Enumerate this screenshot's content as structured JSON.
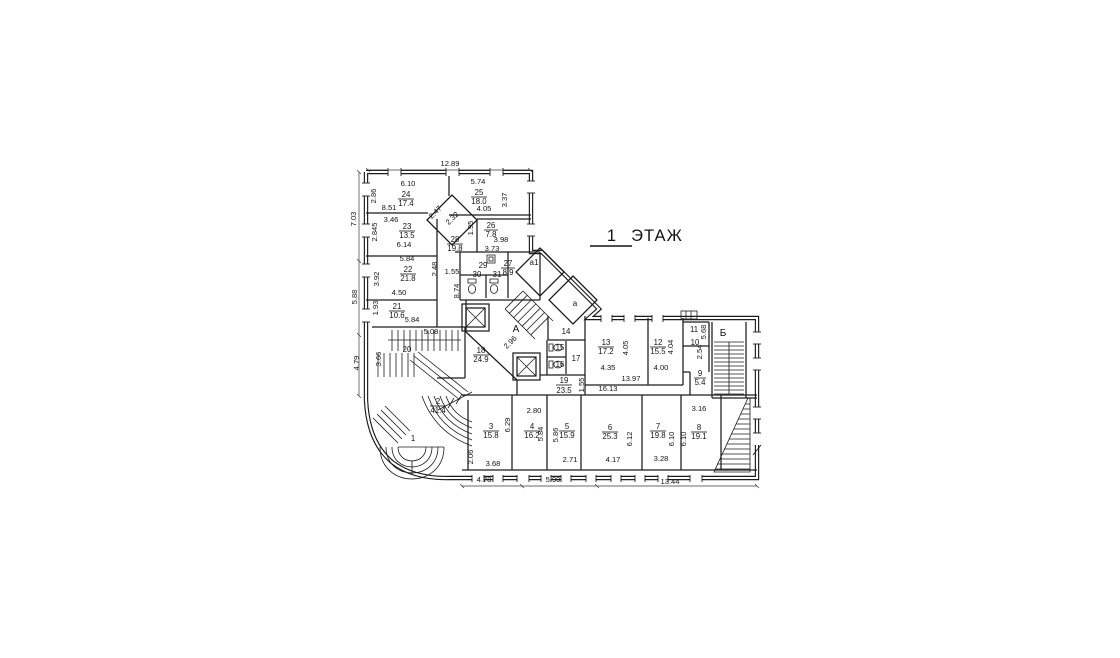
{
  "title": {
    "number": "1",
    "word": "ЭТАЖ"
  },
  "letters": {
    "stair_a": "А",
    "bay_a1": "а1",
    "bay_a": "а",
    "stair_b": "Б"
  },
  "rooms": [
    {
      "num": "1",
      "area": ""
    },
    {
      "num": "2",
      "area": "41.4"
    },
    {
      "num": "3",
      "area": "15.8"
    },
    {
      "num": "4",
      "area": "16.2"
    },
    {
      "num": "5",
      "area": "15.9"
    },
    {
      "num": "6",
      "area": "25.3"
    },
    {
      "num": "7",
      "area": "19.8"
    },
    {
      "num": "8",
      "area": "19.1"
    },
    {
      "num": "9",
      "area": "5.4"
    },
    {
      "num": "10",
      "area": ""
    },
    {
      "num": "11",
      "area": ""
    },
    {
      "num": "12",
      "area": "15.5"
    },
    {
      "num": "13",
      "area": "17.2"
    },
    {
      "num": "14",
      "area": ""
    },
    {
      "num": "15",
      "area": ""
    },
    {
      "num": "16",
      "area": ""
    },
    {
      "num": "17",
      "area": ""
    },
    {
      "num": "18",
      "area": "24.9"
    },
    {
      "num": "19",
      "area": "23.5"
    },
    {
      "num": "20",
      "area": ""
    },
    {
      "num": "21",
      "area": "10.6"
    },
    {
      "num": "22",
      "area": "21.8"
    },
    {
      "num": "23",
      "area": "13.5"
    },
    {
      "num": "24",
      "area": "17.4"
    },
    {
      "num": "25",
      "area": "18.0"
    },
    {
      "num": "26",
      "area": "7.8"
    },
    {
      "num": "27",
      "area": "8.9"
    },
    {
      "num": "28",
      "area": "19.8"
    },
    {
      "num": "29",
      "area": ""
    },
    {
      "num": "30",
      "area": ""
    },
    {
      "num": "31",
      "area": ""
    }
  ],
  "dims": [
    "12.89",
    "6.10",
    "5.74",
    "2.86",
    "8.51",
    "3.37",
    "4.05",
    "3.46",
    "2.47",
    "2.32",
    "2.845",
    "1.95",
    "3.98",
    "6.14",
    "3.73",
    "5.84",
    "3.92",
    "2.48",
    "1.55",
    "8.74",
    "4.50",
    "7.03",
    "5.88",
    "1.93",
    "5.84",
    "5.08",
    "3.66",
    "4.79",
    "2.96",
    "2.80",
    "6.29",
    "2.06",
    "3.68",
    "4.78",
    "5.90",
    "5.84",
    "5.86",
    "2.71",
    "6.12",
    "4.17",
    "6.10",
    "3.28",
    "6.10",
    "3.16",
    "13.44",
    "16.13",
    "1.55",
    "13.97",
    "4.35",
    "4.00",
    "4.05",
    "4.04",
    "5.68",
    "2.54"
  ]
}
